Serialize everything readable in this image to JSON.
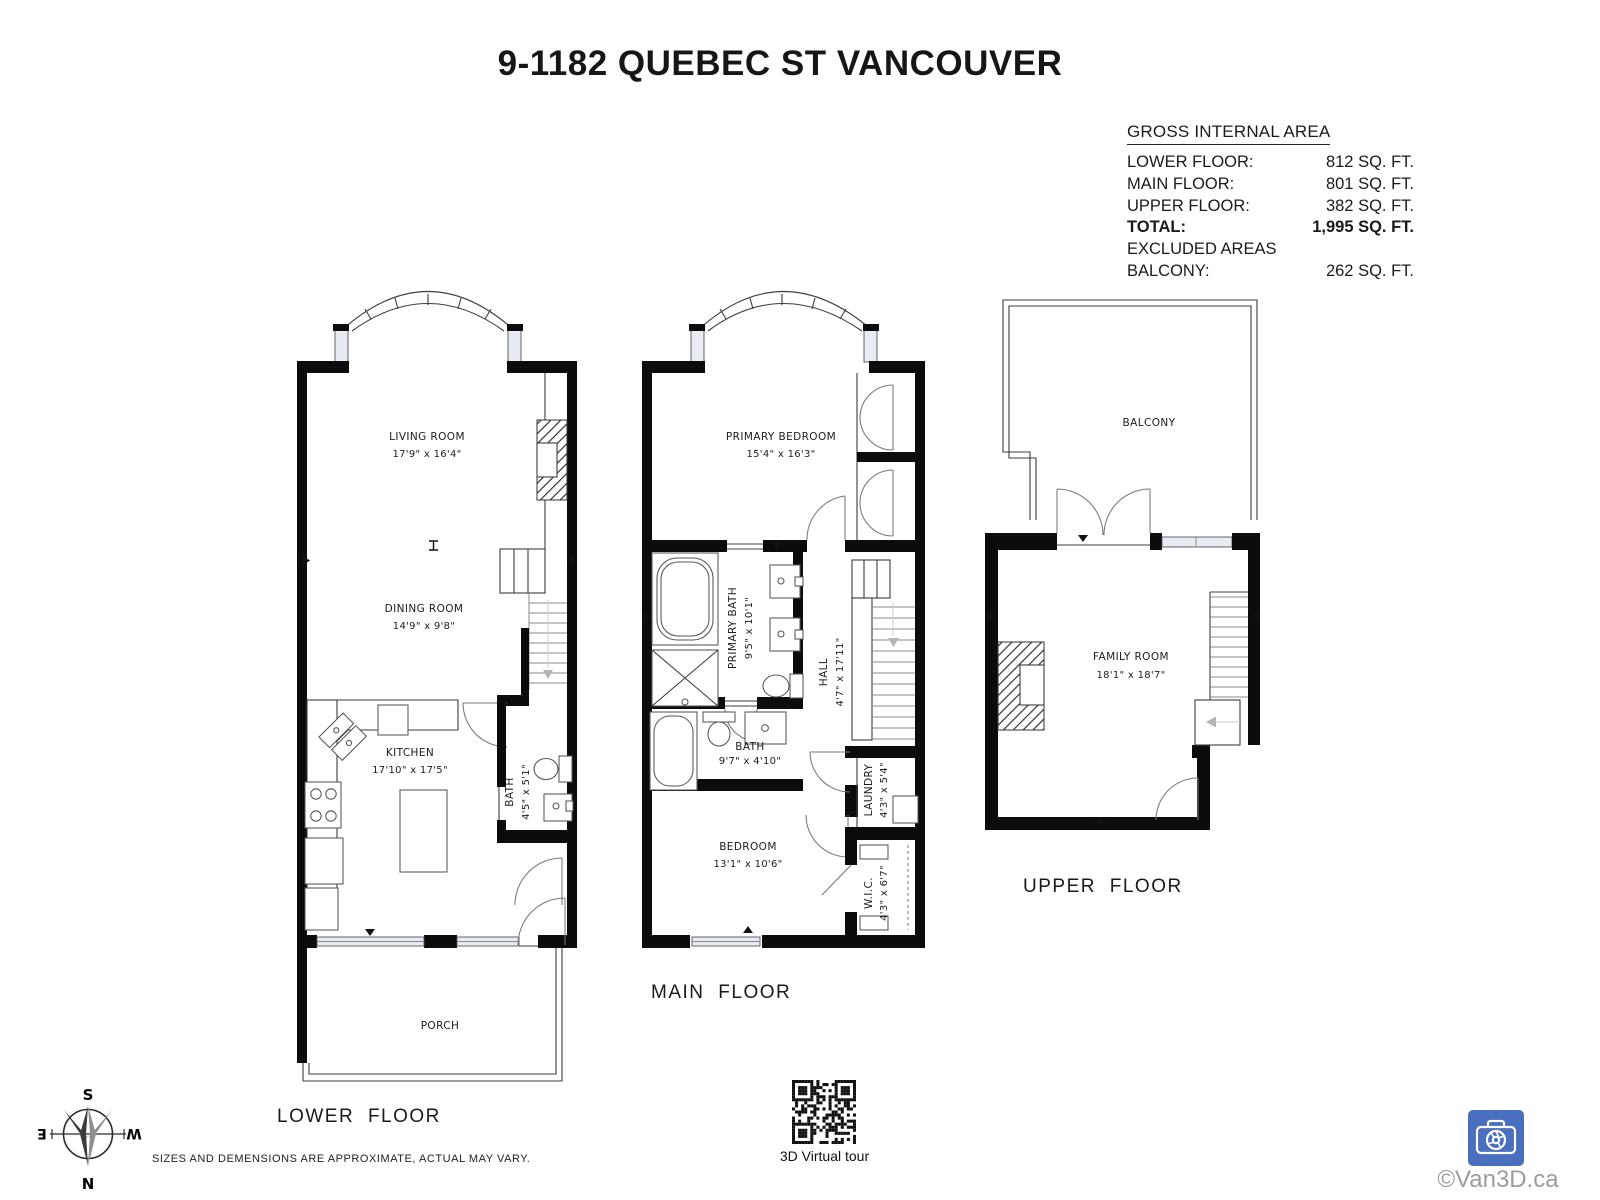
{
  "title": "9-1182 QUEBEC ST VANCOUVER",
  "area_table": {
    "heading": "GROSS INTERNAL AREA",
    "rows": [
      {
        "label": "LOWER FLOOR:",
        "value": "812 SQ. FT."
      },
      {
        "label": "MAIN FLOOR:",
        "value": "801 SQ. FT."
      },
      {
        "label": "UPPER FLOOR:",
        "value": "382 SQ. FT."
      },
      {
        "label": "TOTAL:",
        "value": "1,995 SQ. FT."
      },
      {
        "label": "EXCLUDED AREAS",
        "value": ""
      },
      {
        "label": "BALCONY:",
        "value": "262 SQ. FT."
      }
    ]
  },
  "floors": {
    "lower": {
      "label": "LOWER FLOOR",
      "rooms": {
        "living": {
          "name": "LIVING ROOM",
          "dims": "17'9\" x 16'4\""
        },
        "dining": {
          "name": "DINING ROOM",
          "dims": "14'9\" x 9'8\""
        },
        "kitchen": {
          "name": "KITCHEN",
          "dims": "17'10\" x 17'5\""
        },
        "bath": {
          "name": "BATH",
          "dims": "4'5\" x 5'1\""
        },
        "porch": {
          "name": "PORCH"
        }
      }
    },
    "main": {
      "label": "MAIN FLOOR",
      "rooms": {
        "primary_bedroom": {
          "name": "PRIMARY BEDROOM",
          "dims": "15'4\" x 16'3\""
        },
        "primary_bath": {
          "name": "PRIMARY BATH",
          "dims": "9'5\" x 10'1\""
        },
        "hall": {
          "name": "HALL",
          "dims": "4'7\" x 17'11\""
        },
        "bath": {
          "name": "BATH",
          "dims": "9'7\" x 4'10\""
        },
        "laundry": {
          "name": "LAUNDRY",
          "dims": "4'3\" x 5'4\""
        },
        "bedroom": {
          "name": "BEDROOM",
          "dims": "13'1\" x 10'6\""
        },
        "wic": {
          "name": "W.I.C.",
          "dims": "4'3\" x 6'7\""
        }
      }
    },
    "upper": {
      "label": "UPPER FLOOR",
      "rooms": {
        "balcony": {
          "name": "BALCONY"
        },
        "family": {
          "name": "FAMILY ROOM",
          "dims": "18'1\" x 18'7\""
        }
      }
    }
  },
  "compass": {
    "n": "N",
    "s": "S",
    "e": "E",
    "w": "W"
  },
  "disclaimer": "SIZES AND DEMENSIONS ARE APPROXIMATE, ACTUAL MAY VARY.",
  "qr": {
    "caption": "3D Virtual tour"
  },
  "watermark": {
    "text": "©Van3D.ca",
    "logo_color": "#4a6fbe"
  },
  "colors": {
    "wall": "#0c0c0c",
    "window_fill": "#e8ebf2",
    "hatch": "#333333"
  }
}
